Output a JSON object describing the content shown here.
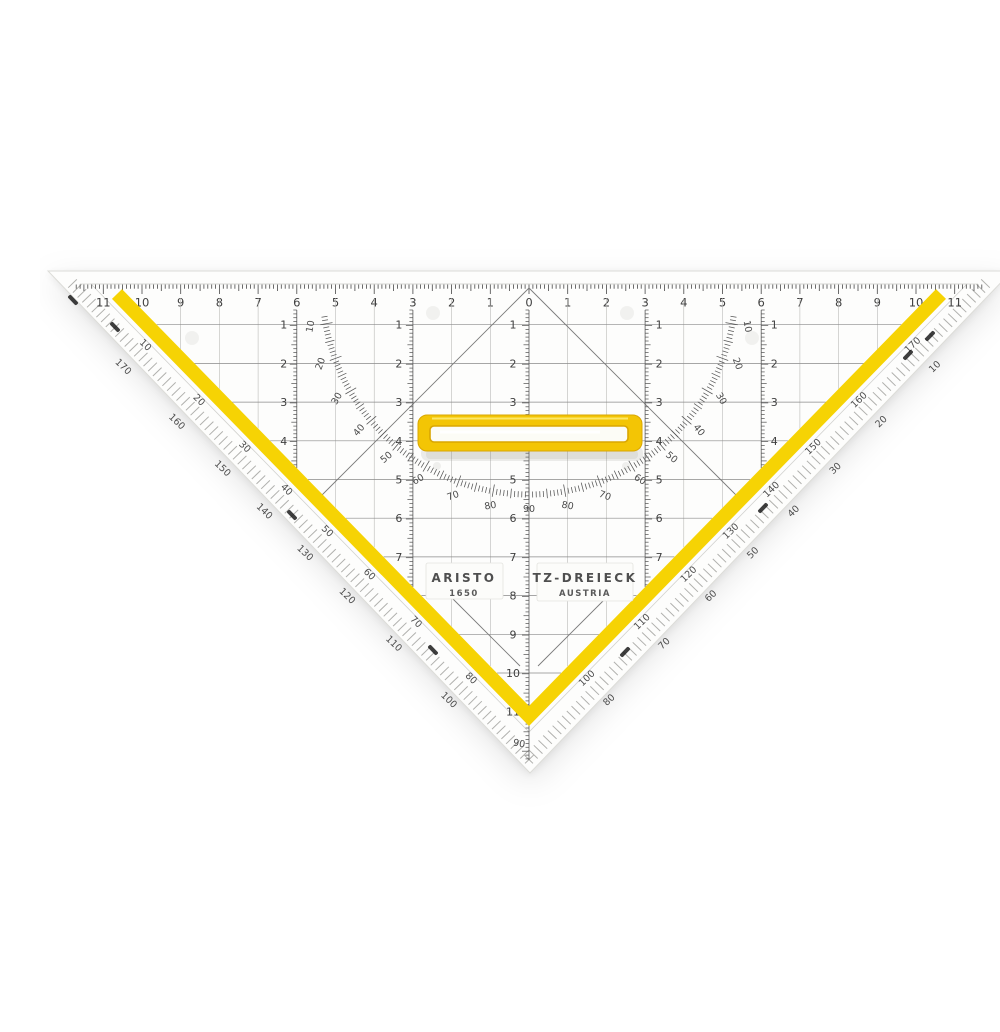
{
  "product": {
    "brand": "ARISTO",
    "model": "1650",
    "type": "TZ-DREIECK",
    "origin": "AUSTRIA"
  },
  "colors": {
    "stripe_yellow": "#F6D304",
    "handle_yellow": "#F3C505",
    "handle_edge": "#D9A602",
    "handle_highlight": "#FCE766",
    "plastic": "#FDFDFC",
    "silhouette_edge": "#DCDCD8",
    "fold_line": "#D2D2CF",
    "bevel_tick": "#B0B0AD",
    "line_dark": "#474747",
    "line_mid": "#8A8A8A",
    "line_light": "#B4B4B2",
    "digit": "#3F3F3F",
    "black_mark": "#1c1c1c"
  },
  "scales": {
    "top": [
      "11",
      "10",
      "9",
      "8",
      "7",
      "6",
      "5",
      "4",
      "3",
      "2",
      "1",
      "0",
      "1",
      "2",
      "3",
      "4",
      "5",
      "6",
      "7",
      "8",
      "9",
      "10",
      "11"
    ],
    "col_center": [
      "1",
      "2",
      "3",
      "4",
      "5",
      "6",
      "7",
      "8",
      "9",
      "10",
      "11"
    ],
    "col_mid": [
      "1",
      "2",
      "3",
      "4",
      "5",
      "6",
      "7"
    ],
    "col_outer": [
      "1",
      "2",
      "3",
      "4"
    ]
  },
  "protractor": {
    "arc": [
      "10",
      "20",
      "30",
      "40",
      "50",
      "60",
      "70",
      "80",
      "90",
      "80",
      "70",
      "60",
      "50",
      "40",
      "30",
      "20",
      "10"
    ],
    "left_inner": [
      "10",
      "20",
      "30",
      "40",
      "50",
      "60",
      "70",
      "80"
    ],
    "left_outer": [
      "170",
      "160",
      "150",
      "140",
      "130",
      "120",
      "110",
      "100"
    ],
    "right_inner": [
      "170",
      "160",
      "150",
      "140",
      "130",
      "120",
      "110",
      "100"
    ],
    "right_outer": [
      "10",
      "20",
      "30",
      "40",
      "50",
      "60",
      "70",
      "80"
    ],
    "vertex": "90"
  }
}
